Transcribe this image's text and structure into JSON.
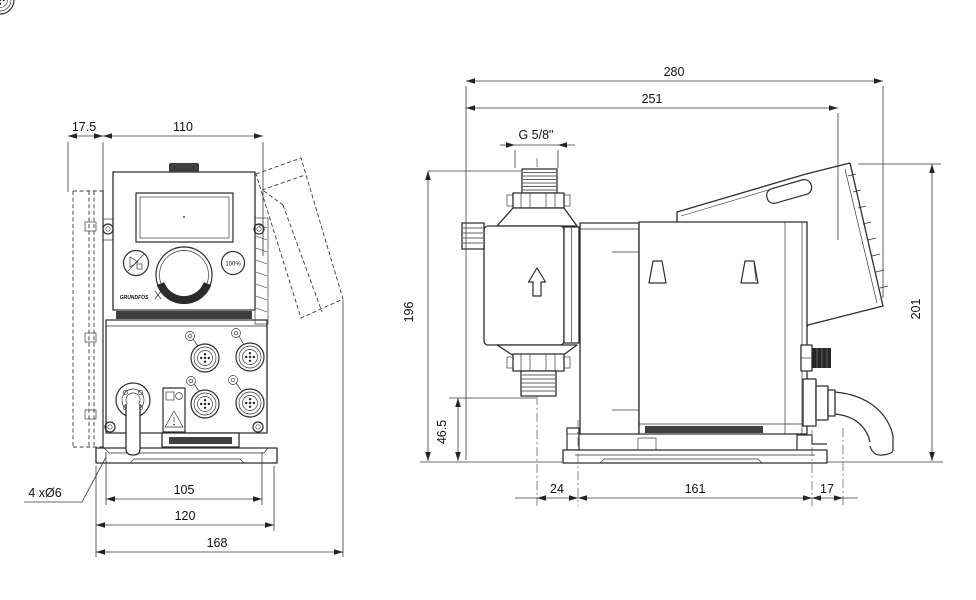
{
  "front_view": {
    "dimensions": {
      "bracket_offset": "17.5",
      "cube_width": "110",
      "hole_pitch": "105",
      "plate_width": "120",
      "overall_width": "168",
      "mounting_holes_note": "4 xØ6"
    },
    "controls": {
      "full_capacity_button": "100%",
      "brand_logo": "GRUNDFOS"
    }
  },
  "side_view": {
    "dimensions": {
      "overall_depth": "280",
      "depth_to_control_cube": "251",
      "connection_thread": "G 5/8\"",
      "height_to_connection": "196",
      "overall_height": "201",
      "connection_clearance": "46.5",
      "foot_front_offset": "24",
      "foot_length": "161",
      "foot_rear_offset": "17"
    }
  },
  "colors": {
    "line": "#2d2d2d",
    "dimension": "#3a3a3a",
    "text": "#111111",
    "dark_fill": "#3f3f3f",
    "background": "#ffffff"
  }
}
